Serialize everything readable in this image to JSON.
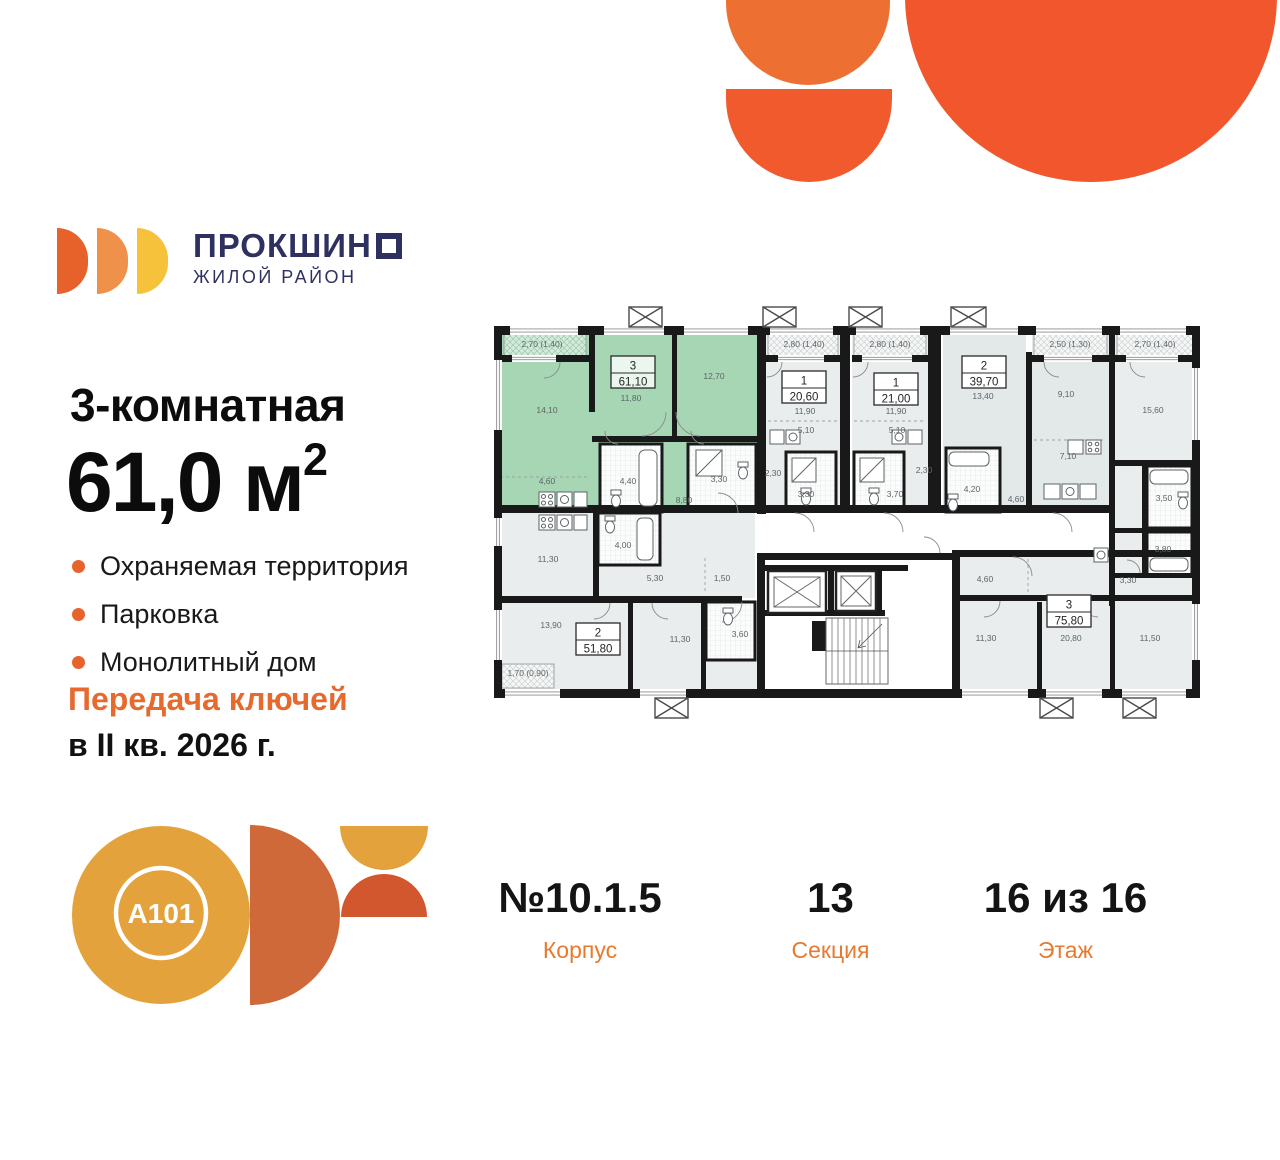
{
  "brand": {
    "name_main": "ПРОКШИН",
    "name_last_letter": "О",
    "subtitle": "ЖИЛОЙ РАЙОН"
  },
  "listing": {
    "rooms_title": "3-комнатная",
    "area_value": "61,0 м",
    "area_sup": "2",
    "features": [
      "Охраняемая территория",
      "Парковка",
      "Монолитный дом"
    ],
    "keys_line1": "Передача ключей",
    "keys_line2": "в II кв. 2026 г."
  },
  "a101": {
    "label": "A101"
  },
  "footer": {
    "items": [
      {
        "value": "№10.1.5",
        "label": "Корпус"
      },
      {
        "value": "13",
        "label": "Секция"
      },
      {
        "value": "16 из 16",
        "label": "Этаж"
      }
    ]
  },
  "colors": {
    "accent_orange": "#e8632b",
    "brand_navy": "#2e3160",
    "highlight_green": "#a7d6b5",
    "deco_orange": "#f1562c"
  },
  "plan": {
    "highlighted_unit": {
      "number": "3",
      "area": "61,10"
    },
    "units": [
      {
        "num": "3",
        "area": "61,10",
        "cx": 633,
        "top": 356,
        "green": true
      },
      {
        "num": "1",
        "area": "20,60",
        "cx": 804,
        "top": 371
      },
      {
        "num": "1",
        "area": "21,00",
        "cx": 896,
        "top": 373
      },
      {
        "num": "2",
        "area": "39,70",
        "cx": 984,
        "top": 356
      },
      {
        "num": "2",
        "area": "51,80",
        "cx": 598,
        "top": 623
      },
      {
        "num": "3",
        "area": "75,80",
        "cx": 1069,
        "top": 595
      }
    ],
    "room_labels": [
      {
        "t": "2,70 (1,40)",
        "x": 542,
        "y": 347
      },
      {
        "t": "14,10",
        "x": 547,
        "y": 413
      },
      {
        "t": "11,80",
        "x": 631,
        "y": 401
      },
      {
        "t": "12,70",
        "x": 714,
        "y": 379
      },
      {
        "t": "4,60",
        "x": 547,
        "y": 484
      },
      {
        "t": "4,40",
        "x": 628,
        "y": 484
      },
      {
        "t": "3,30",
        "x": 719,
        "y": 482
      },
      {
        "t": "8,80",
        "x": 684,
        "y": 503
      },
      {
        "t": "2,80 (1,40)",
        "x": 804,
        "y": 347
      },
      {
        "t": "11,90",
        "x": 805,
        "y": 414
      },
      {
        "t": "5,10",
        "x": 806,
        "y": 433
      },
      {
        "t": "2,30",
        "x": 773,
        "y": 476
      },
      {
        "t": "3,30",
        "x": 806,
        "y": 497
      },
      {
        "t": "2,80 (1,40)",
        "x": 890,
        "y": 347
      },
      {
        "t": "11,90",
        "x": 896,
        "y": 414
      },
      {
        "t": "5,10",
        "x": 897,
        "y": 433
      },
      {
        "t": "2,30",
        "x": 924,
        "y": 473
      },
      {
        "t": "3,70",
        "x": 895,
        "y": 497
      },
      {
        "t": "13,40",
        "x": 983,
        "y": 399
      },
      {
        "t": "4,20",
        "x": 972,
        "y": 492
      },
      {
        "t": "4,60",
        "x": 1016,
        "y": 502
      },
      {
        "t": "9,10",
        "x": 1066,
        "y": 397
      },
      {
        "t": "7,10",
        "x": 1068,
        "y": 459
      },
      {
        "t": "2,50 (1,30)",
        "x": 1070,
        "y": 347
      },
      {
        "t": "2,70 (1,40)",
        "x": 1155,
        "y": 347
      },
      {
        "t": "15,60",
        "x": 1153,
        "y": 413
      },
      {
        "t": "3,50",
        "x": 1164,
        "y": 501
      },
      {
        "t": "3,80",
        "x": 1163,
        "y": 552
      },
      {
        "t": "3,30",
        "x": 1128,
        "y": 583
      },
      {
        "t": "11,50",
        "x": 1150,
        "y": 641
      },
      {
        "t": "4,60",
        "x": 985,
        "y": 582
      },
      {
        "t": "11,30",
        "x": 986,
        "y": 641
      },
      {
        "t": "20,80",
        "x": 1071,
        "y": 641
      },
      {
        "t": "11,30",
        "x": 548,
        "y": 562
      },
      {
        "t": "4,00",
        "x": 623,
        "y": 548
      },
      {
        "t": "5,30",
        "x": 655,
        "y": 581
      },
      {
        "t": "1,50",
        "x": 722,
        "y": 581
      },
      {
        "t": "13,90",
        "x": 551,
        "y": 628
      },
      {
        "t": "11,30",
        "x": 680,
        "y": 642
      },
      {
        "t": "3,60",
        "x": 740,
        "y": 637
      },
      {
        "t": "1,70 (0,90)",
        "x": 528,
        "y": 676
      }
    ]
  }
}
